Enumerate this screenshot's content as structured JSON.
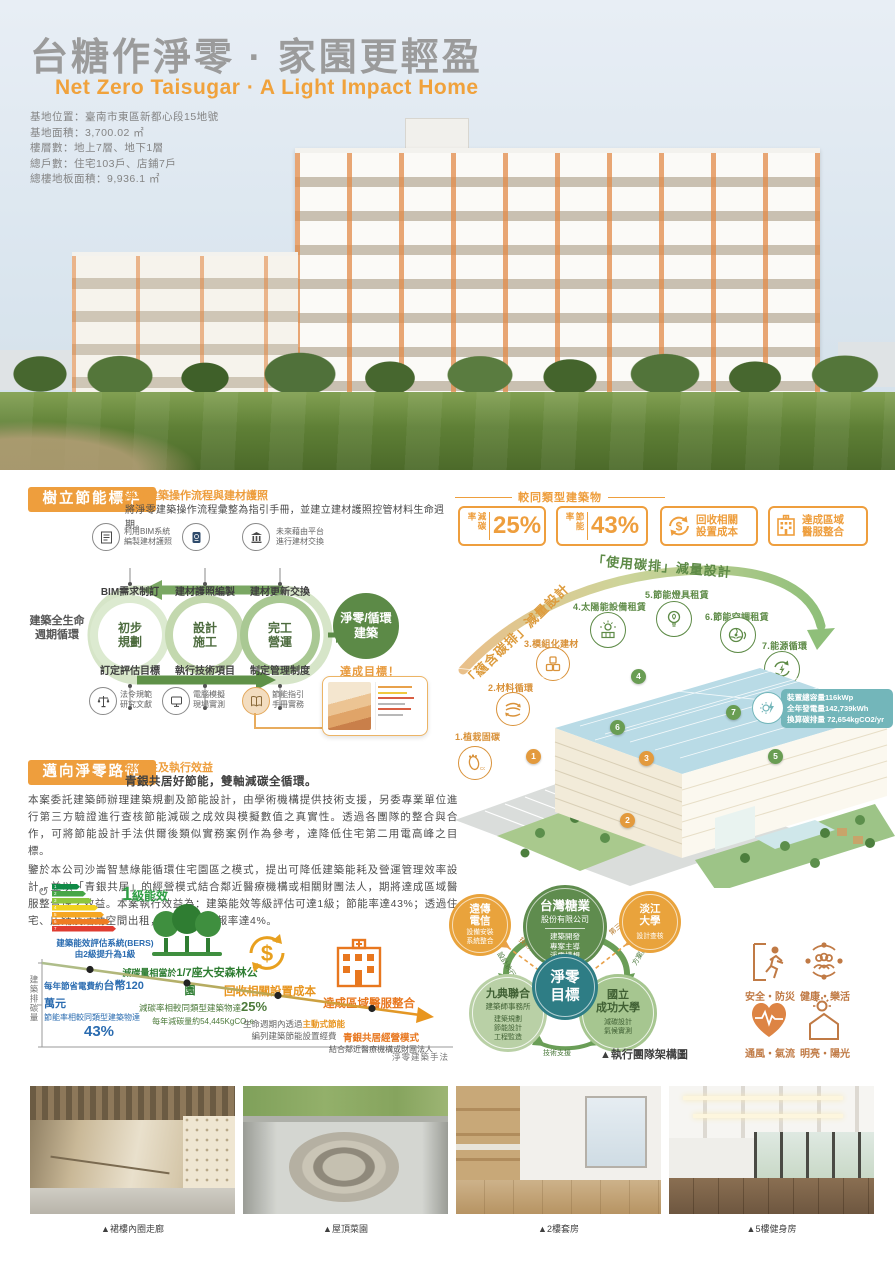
{
  "colors": {
    "orange": "#EE9E3D",
    "green": "#5C8A47",
    "teal": "#2F7F87",
    "gray_title": "#9B9B9B"
  },
  "header": {
    "title": "台糖作淨零 · 家園更輕盈",
    "subtitle": "Net Zero Taisugar · A Light Impact Home",
    "info": [
      "基地位置：臺南市東區新都心段15地號",
      "基地面積：3,700.02 ㎡",
      "樓層數：地上7層、地下1層",
      "總戶數：住宅103戶、店鋪7戶",
      "總樓地板面積：9,936.1 ㎡"
    ]
  },
  "s1": {
    "title": "樹立節能標竿",
    "subtitle": "淨零建築操作流程與建材護照",
    "desc": "將淨零建築操作流程彙整為指引手冊，並建立建材護照控管材料生命週期。",
    "icons_top": [
      {
        "l1": "利用BIM系統",
        "l2": "編製建材護照"
      },
      {
        "l1": "",
        "l2": ""
      },
      {
        "l1": "未來藉由平台",
        "l2": "進行建材交換"
      }
    ],
    "cycle_label": [
      "建築全生命",
      "週期循環"
    ],
    "phases": [
      {
        "top": "BIM需求制訂",
        "c1": "初步",
        "c2": "規劃",
        "bot": "訂定評估目標"
      },
      {
        "top": "建材護照編製",
        "c1": "設計",
        "c2": "施工",
        "bot": "執行技術項目"
      },
      {
        "top": "建材更新交換",
        "c1": "完工",
        "c2": "營運",
        "bot": "制定管理制度"
      }
    ],
    "result": [
      "淨零/循環",
      "建築"
    ],
    "goal": "達成目標！",
    "icons_bot": [
      {
        "l1": "法令規範",
        "l2": "研究文獻"
      },
      {
        "l1": "電腦模擬",
        "l2": "現場實測"
      },
      {
        "l1": "節能指引",
        "l2": "手冊實務"
      }
    ]
  },
  "stats": {
    "header": "較同類型建築物",
    "b1": {
      "label": "減碳率",
      "value": "25%"
    },
    "b2": {
      "label": "節能率",
      "value": "43%"
    },
    "b3": {
      "l1": "回收相關",
      "l2": "設置成本"
    },
    "b4": {
      "l1": "達成區域",
      "l2": "醫服整合"
    }
  },
  "usage": {
    "arc_left": "「蘊含碳排」減量設計",
    "arc_right": "「使用碳排」減量設計",
    "callouts": [
      "1.植栽固碳",
      "2.材料循環",
      "3.模組化建材",
      "4.太陽能設備租賃",
      "5.節能燈具租賃",
      "6.節能空調租賃",
      "7.能源循環"
    ],
    "markers": [
      "1",
      "2",
      "3",
      "4",
      "5",
      "6",
      "7"
    ],
    "energy": [
      "裝置總容量116kWp",
      "全年發電量142,739kWh",
      "換算碳排量 72,654kgCO2/yr"
    ]
  },
  "s2": {
    "title": "邁向淨零路徑",
    "subtitle": "可行性及執行效益",
    "tagline": "青銀共居好節能，雙軸減碳全循環。",
    "para1": "本案委託建築師辦理建築規劃及節能設計，由學術機構提供技術支援，另委專業單位進行第三方驗證進行查核節能減碳之成效與模擬數值之真實性。透過各團隊的整合與合作，可將節能設計手法供爾後類似實務案例作為參考，達降低住宅第二用電高峰之目標。",
    "para2": "鑒於本公司沙崙智慧綠能循環住宅園區之模式，提出可降低建築能耗及營運管理效率設計，並以「青銀共居」的經營模式結合鄰近醫療機構或相關財團法人，期將達成區域醫服整合性之效益。本案執行效益為：建築能效等級評估可達1級；節能率達43%；透過住宅、店鋪及活動空間出租，計算現值投報率達4%。"
  },
  "roadmap": {
    "bers": [
      "1",
      "2",
      "3",
      "4",
      "5",
      "6",
      "7"
    ],
    "grade_big": "1",
    "grade_rest": "級能效",
    "note1": "建築能效評估系統(BERS)",
    "note2": "由2級提升為1級",
    "yaxis": "建築排碳量",
    "xaxis": "淨零建築手法",
    "stop1": {
      "a": "每年節省電費約",
      "b": "台幣120萬元",
      "c": "節能率相較同類型建築物達",
      "d": "43%"
    },
    "stop2": {
      "a": "減碳量相當於",
      "b": "1/7座大安森林公園",
      "c": "減碳率相較同類型建築物達",
      "d": "25%",
      "e": "每年減碳量約54,445KgCO₂e"
    },
    "stop3": {
      "a": "回收相關設置成本",
      "b": "生命週期內透過",
      "c": "主動式節能",
      "d": "編列建築節能設置經費"
    },
    "stop4": {
      "a": "達成區域醫服整合",
      "b": "青銀共居經營模式",
      "c": "結合鄰近醫療機構或財團法人"
    }
  },
  "team": {
    "center": [
      "淨零",
      "目標"
    ],
    "top": {
      "name": "台灣糖業",
      "sub": "股份有限公司",
      "d1": "建築開發",
      "d2": "專案主導",
      "d3": "淨零構想"
    },
    "left": {
      "name": "遠傳",
      "name2": "電信",
      "d1": "設備安裝",
      "d2": "系統整合"
    },
    "right": {
      "name": "淡江",
      "name2": "大學",
      "d1": "設計查核"
    },
    "bl": {
      "name": "九典聯合",
      "sub": "建築師事務所",
      "d1": "建築規劃",
      "d2": "節能設計",
      "d3": "工程監造"
    },
    "br": {
      "name": "國立",
      "name2": "成功大學",
      "d1": "減碳設計",
      "d2": "氣候實測"
    },
    "arrow_tl": "技術實驗",
    "arrow_l": "設計執行",
    "arrow_tr": "第三方驗證",
    "arrow_r": "方案評估",
    "arrow_b": "技術支援",
    "caption": "▲執行團隊架構圖"
  },
  "benefits": [
    "安全・防災",
    "健康・樂活",
    "通風・氣流",
    "明亮・陽光"
  ],
  "photos": [
    "▲裙樓內圈走廊",
    "▲屋頂菜園",
    "▲2樓套房",
    "▲5樓健身房"
  ]
}
